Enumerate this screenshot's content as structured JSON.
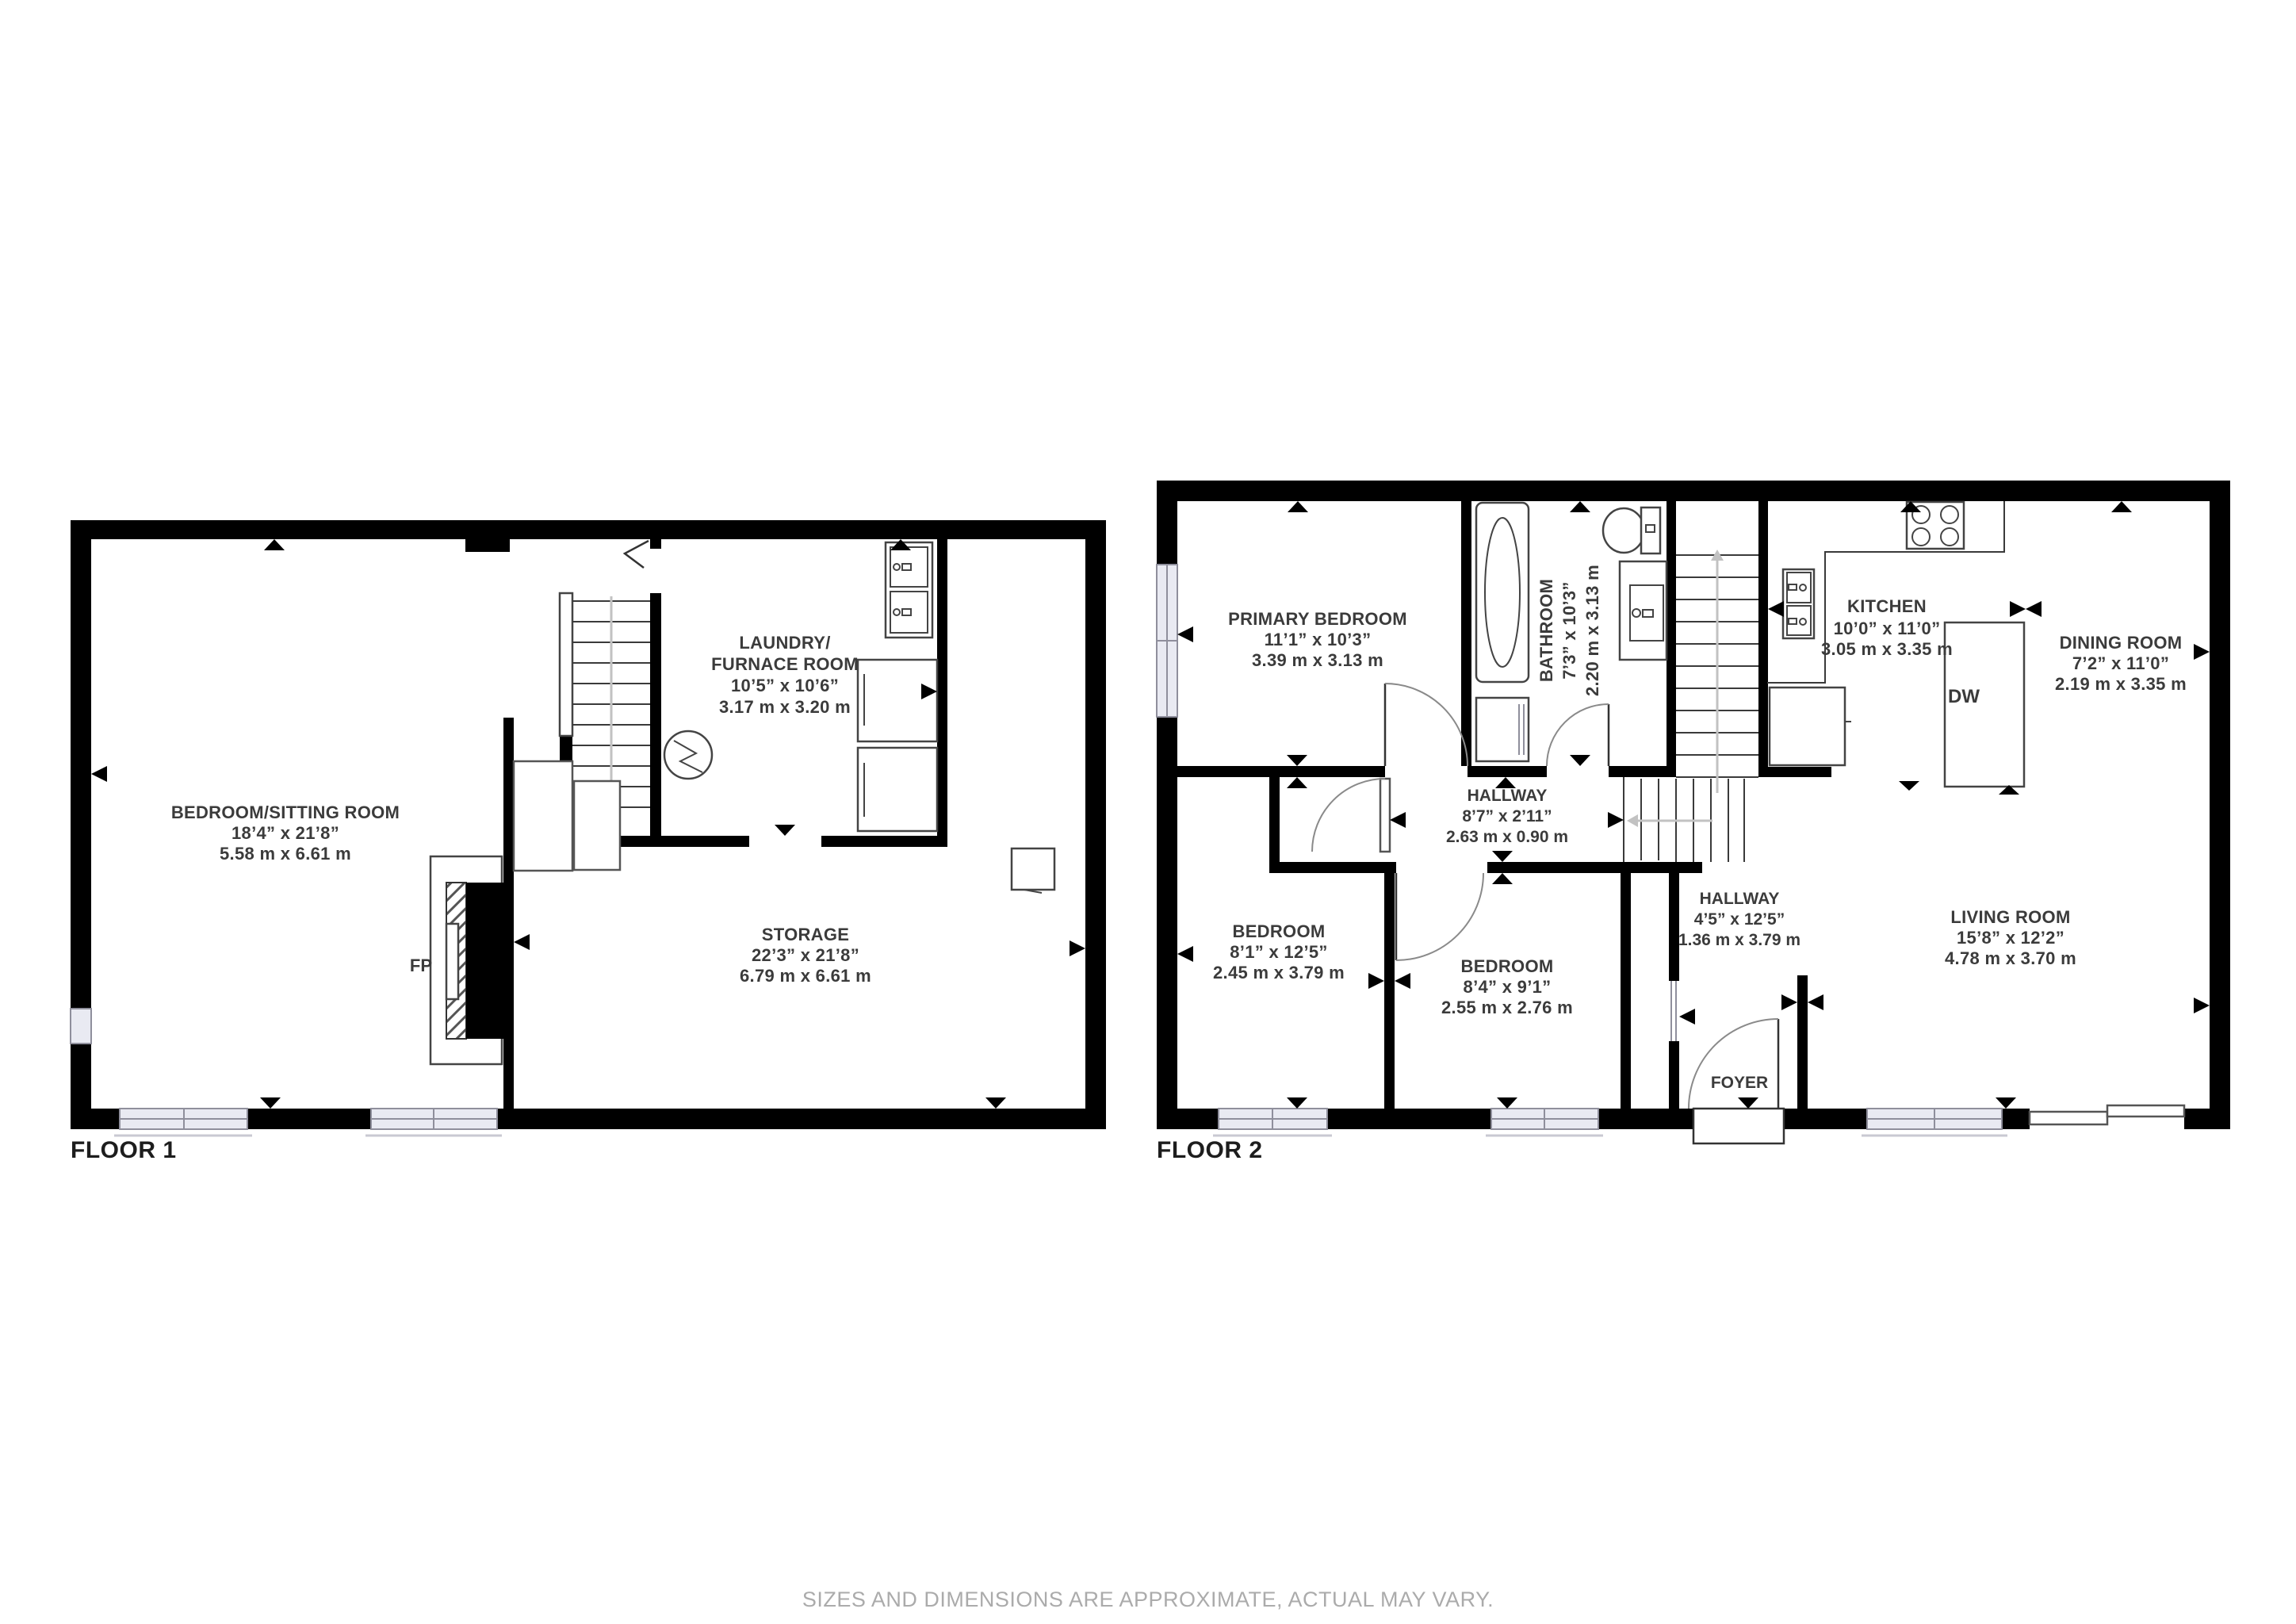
{
  "floor1": {
    "label": "FLOOR 1",
    "rooms": {
      "bedroom_sitting": {
        "name": "BEDROOM/SITTING ROOM",
        "size_imperial": "18’4” x 21’8”",
        "size_metric": "5.58 m x 6.61 m"
      },
      "laundry_furnace": {
        "name_line1": "LAUNDRY/",
        "name_line2": "FURNACE ROOM",
        "size_imperial": "10’5” x 10’6”",
        "size_metric": "3.17 m x 3.20 m"
      },
      "storage": {
        "name": "STORAGE",
        "size_imperial": "22’3” x 21’8”",
        "size_metric": "6.79 m x 6.61 m"
      },
      "fireplace": {
        "label": "FP"
      }
    }
  },
  "floor2": {
    "label": "FLOOR 2",
    "rooms": {
      "primary_bedroom": {
        "name": "PRIMARY BEDROOM",
        "size_imperial": "11’1” x 10’3”",
        "size_metric": "3.39 m x 3.13 m"
      },
      "bathroom": {
        "name": "BATHROOM",
        "size_imperial": "7’3” x 10’3”",
        "size_metric": "2.20 m x 3.13 m"
      },
      "hallway_main": {
        "name": "HALLWAY",
        "size_imperial": "8’7” x 2’11”",
        "size_metric": "2.63 m x 0.90 m"
      },
      "bedroom_left": {
        "name": "BEDROOM",
        "size_imperial": "8’1” x 12’5”",
        "size_metric": "2.45 m x 3.79 m"
      },
      "bedroom_middle": {
        "name": "BEDROOM",
        "size_imperial": "8’4” x 9’1”",
        "size_metric": "2.55 m x 2.76 m"
      },
      "hallway_vertical": {
        "name": "HALLWAY",
        "size_imperial": "4’5” x 12’5”",
        "size_metric": "1.36 m x 3.79 m"
      },
      "foyer": {
        "name": "FOYER"
      },
      "kitchen": {
        "name": "KITCHEN",
        "size_imperial": "10’0” x 11’0”",
        "size_metric": "3.05 m x 3.35 m",
        "dishwasher_label": "DW"
      },
      "dining_room": {
        "name": "DINING ROOM",
        "size_imperial": "7’2” x 11’0”",
        "size_metric": "2.19 m x 3.35 m"
      },
      "living_room": {
        "name": "LIVING ROOM",
        "size_imperial": "15’8” x 12’2”",
        "size_metric": "4.78 m x 3.70 m"
      }
    }
  },
  "footer": {
    "disclaimer": "SIZES AND DIMENSIONS ARE APPROXIMATE, ACTUAL MAY VARY."
  }
}
